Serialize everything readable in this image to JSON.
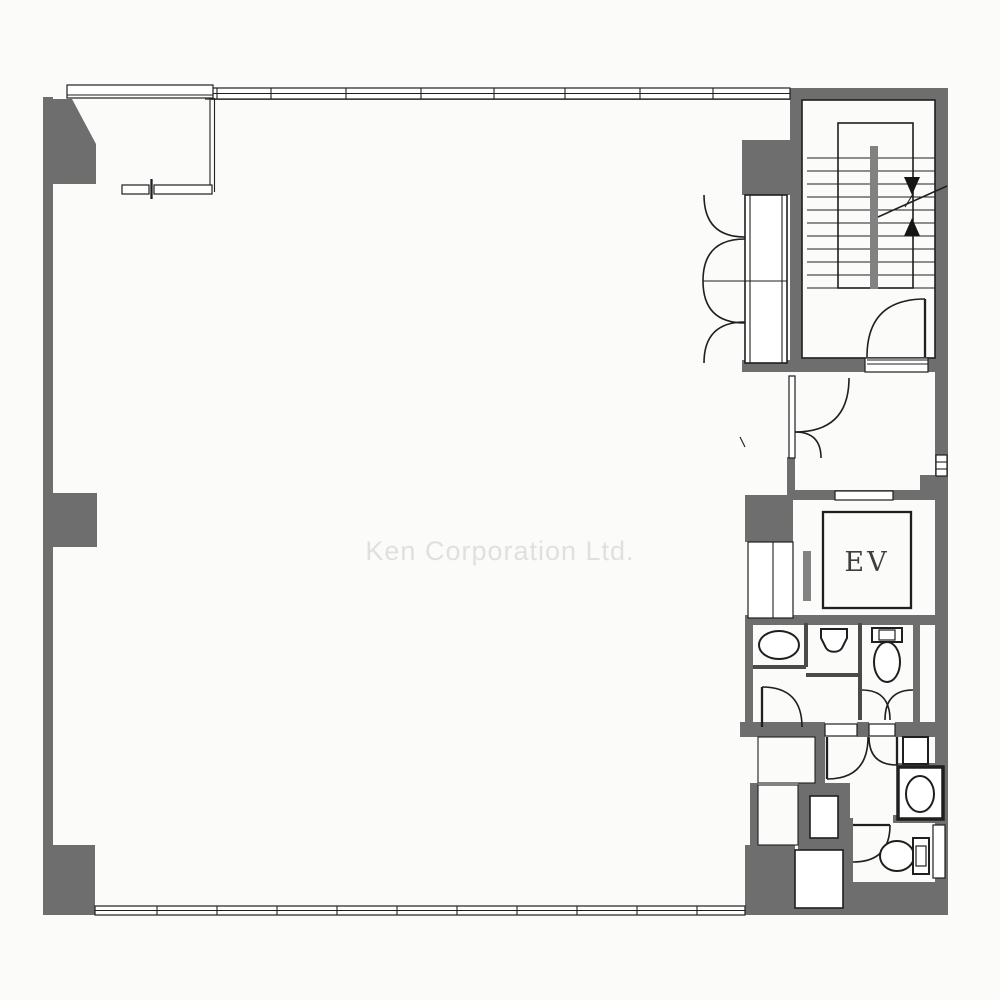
{
  "document": {
    "type": "architectural floor plan",
    "watermark": "Ken Corporation Ltd."
  },
  "labels": {
    "elevator": "EV"
  },
  "colors": {
    "background": "#fbfbfa",
    "wall": "#6e6e6e",
    "line": "#1f1f1f",
    "fixture_partition": "#4a4a4a",
    "stair_rail": "#828282",
    "watermark_text": "#e0e0de"
  }
}
